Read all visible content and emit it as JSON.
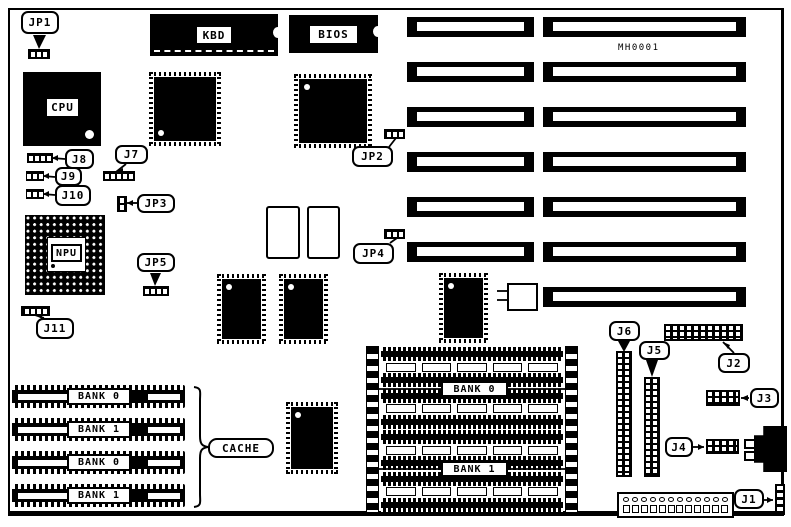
{
  "board": {
    "part_number": "MH0001"
  },
  "chip_labels": {
    "kbd": "KBD",
    "bios": "BIOS",
    "cpu": "CPU",
    "npu": "NPU"
  },
  "cache": {
    "label": "CACHE",
    "banks": [
      "BANK 0",
      "BANK 1",
      "BANK 0",
      "BANK 1"
    ]
  },
  "memory_array": {
    "bank_labels": [
      "BANK 0",
      "BANK 1"
    ],
    "rows": [
      "socket",
      "empty",
      "socket",
      "socket",
      "empty",
      "socket",
      "socket",
      "empty",
      "socket",
      "socket",
      "empty",
      "socket"
    ],
    "empty_sockets_per_row": 5
  },
  "jumpers": {
    "jp1": {
      "label": "JP1",
      "pins": 3
    },
    "jp2": {
      "label": "JP2",
      "pins": 3
    },
    "jp3": {
      "label": "JP3",
      "pins": 2
    },
    "jp4": {
      "label": "JP4",
      "pins": 3
    },
    "jp5": {
      "label": "JP5",
      "pins": 4
    },
    "j7": {
      "label": "J7",
      "pins": 5
    },
    "j8": {
      "label": "J8",
      "pins": 4
    },
    "j9": {
      "label": "J9",
      "pins": 3
    },
    "j10": {
      "label": "J10",
      "pins": 3
    },
    "j11": {
      "label": "J11",
      "pins": 4
    }
  },
  "connectors": {
    "j1": {
      "label": "J1"
    },
    "j2": {
      "label": "J2"
    },
    "j3": {
      "label": "J3"
    },
    "j4": {
      "label": "J4"
    },
    "j5": {
      "label": "J5"
    },
    "j6": {
      "label": "J6"
    }
  },
  "slots": {
    "rows": [
      {
        "left": true,
        "right": true
      },
      {
        "left": true,
        "right": true
      },
      {
        "left": true,
        "right": true
      },
      {
        "left": true,
        "right": true
      },
      {
        "left": true,
        "right": true
      },
      {
        "left": true,
        "right": true
      },
      {
        "left": false,
        "right": true
      }
    ]
  },
  "power_connector": {
    "pins_per_row": 12
  }
}
